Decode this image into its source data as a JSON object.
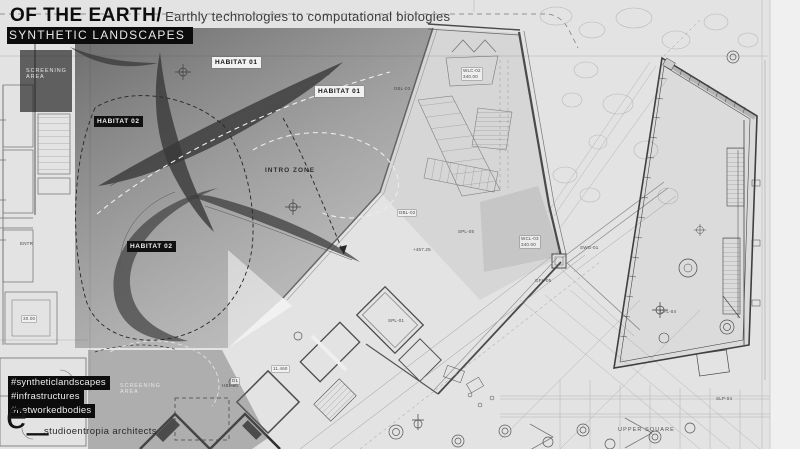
{
  "header": {
    "title": "OF THE EARTH/",
    "subtitle": "Earthly technologies to computational biologies",
    "banner": "SYNTHETIC LANDSCAPES"
  },
  "hashtags": [
    "#syntheticlandscapes",
    "#infrastructures",
    "#networkedbodies"
  ],
  "footer": {
    "logo": "e_",
    "studio": "studioentropia architects"
  },
  "zone_labels": [
    {
      "text": "HABITAT 01",
      "x": 212,
      "y": 57,
      "variant": "light"
    },
    {
      "text": "HABITAT 01",
      "x": 315,
      "y": 86,
      "variant": "light"
    },
    {
      "text": "HABITAT 02",
      "x": 94,
      "y": 116,
      "variant": "dark"
    },
    {
      "text": "HABITAT 02",
      "x": 127,
      "y": 241,
      "variant": "dark"
    },
    {
      "text": "INTRO ZONE",
      "x": 262,
      "y": 165,
      "variant": "plain"
    },
    {
      "text": "SCREENING\nAREA",
      "x": 23,
      "y": 66,
      "variant": "screen"
    },
    {
      "text": "SCREENING\nAREA",
      "x": 117,
      "y": 381,
      "variant": "screen"
    }
  ],
  "plan_labels": [
    {
      "text": "WLC-02\n340.00",
      "x": 462,
      "y": 68,
      "boxed": true
    },
    {
      "text": "DBL-03",
      "x": 394,
      "y": 86
    },
    {
      "text": "DBL-02",
      "x": 398,
      "y": 210,
      "boxed": true
    },
    {
      "text": "SPL-05",
      "x": 458,
      "y": 229
    },
    {
      "text": "+457.25",
      "x": 413,
      "y": 247
    },
    {
      "text": "WCL-03\n340.00",
      "x": 520,
      "y": 236,
      "boxed": true
    },
    {
      "text": "SWG-01",
      "x": 580,
      "y": 245
    },
    {
      "text": "GFL-05",
      "x": 535,
      "y": 278
    },
    {
      "text": "SPL-01",
      "x": 388,
      "y": 318
    },
    {
      "text": "CFL-04",
      "x": 660,
      "y": 309
    },
    {
      "text": "SLP-04",
      "x": 716,
      "y": 396
    },
    {
      "text": "HBL-01",
      "x": 222,
      "y": 383
    },
    {
      "text": "11.460",
      "x": 272,
      "y": 366,
      "boxed": true
    },
    {
      "text": "D1",
      "x": 231,
      "y": 378,
      "boxed": true
    },
    {
      "text": "ENTR",
      "x": 20,
      "y": 241
    },
    {
      "text": "30.00",
      "x": 22,
      "y": 316,
      "boxed": true
    },
    {
      "text": "UPPER SQUARE",
      "x": 618,
      "y": 427,
      "variant": "upper"
    }
  ],
  "colors": {
    "background": "#e3e3e3",
    "ink": "#0e0e0e",
    "subtitle_ink": "#3c3c3c",
    "banner_bg": "#0c0c0c",
    "banner_text": "#e8e8e8",
    "label_light_bg": "#f2f2f2",
    "label_dark_bg": "#111111",
    "overlay_dark": "rgba(20,20,20,0.55)",
    "overlay_light": "rgba(110,110,110,0.30)"
  }
}
